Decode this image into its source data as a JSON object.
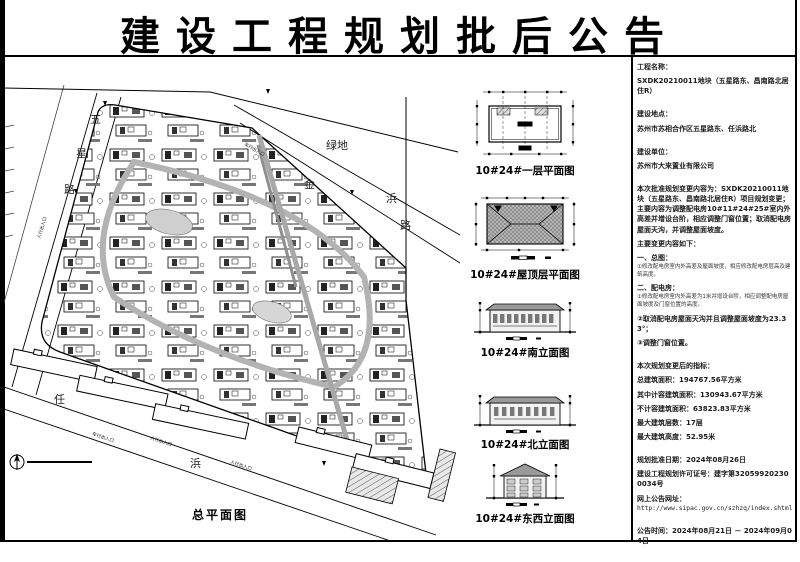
{
  "title": "建设工程规划批后公告",
  "site_plan": {
    "caption": "总平面图",
    "road_west": [
      "五",
      "星",
      "路"
    ],
    "road_north": [
      "金",
      "浜",
      "路"
    ],
    "road_south": [
      "任",
      "浜"
    ],
    "green_area": "绿地",
    "entrance_ped": "人行出入口",
    "entrance_veh": "车行出入口"
  },
  "drawings": {
    "plan1_caption": "10#24#一层平面图",
    "roof_caption": "10#24#屋顶层平面图",
    "south_caption": "10#24#南立面图",
    "north_caption": "10#24#北立面图",
    "eastwest_caption": "10#24#东西立面图"
  },
  "info": {
    "project_name_label": "工程名称：",
    "project_name": "SXDK20210011地块（五星路东、昌南路北居住R）",
    "location_label": "建设地点：",
    "location": "苏州市苏相合作区五星路东、任浜路北",
    "builder_label": "建设单位：",
    "builder": "苏州市大来置业有限公司",
    "change_paragraph": "本次批准规划变更内容为：SXDK20210011地块（五星路东、昌南路北居住R）项目规划变更；主要内容为调整配电房10#11#24#25#室内外高差并增设台阶，相应调整门窗位置；取消配电房屋面天沟，并调整屋面坡度。",
    "changes_heading": "主要变更内容如下：",
    "section1_title": "一、总图：",
    "section1_item1": "①修改配电房室内外高差及屋面坡度，相应修改配电房层高及建筑高度。",
    "section2_title": "二、配电房：",
    "section2_item1": "①修改配电房室内外高差为1米并增设台阶，相应调整配电房屋面坡度及门窗位置的高度。",
    "section2_item2": "②取消配电房屋面天沟并且调整屋面坡度为23.33°；",
    "section2_item3": "③调整门窗位置。",
    "indicators_heading": "本次规划变更后的指标：",
    "indicators": [
      "总建筑面积：194767.56平方米",
      "其中计容建筑面积：130943.67平方米",
      "不计容建筑面积：63823.83平方米",
      "最大建筑层数：17层",
      "最大建筑高度：52.95米"
    ],
    "approval_date": "规划批准日期：2024年08月26日",
    "permit_no": "建设工程规划许可证号：建字第320599202300034号",
    "url_label": "网上公告网址：",
    "url": "http://www.sipac.gov.cn/szhzq/index.shtml",
    "notice_period": "公告时间：2024年08月21日 － 2024年09月04日"
  }
}
